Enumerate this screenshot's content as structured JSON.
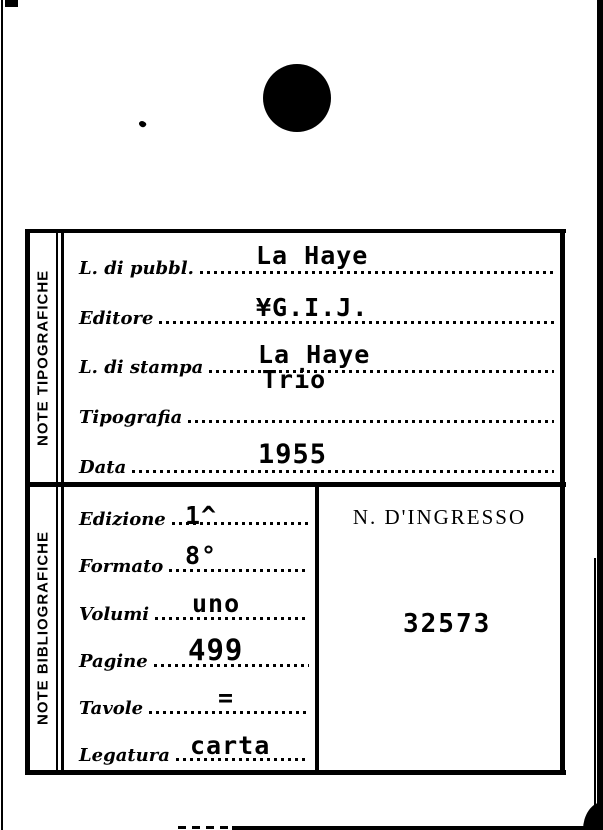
{
  "colors": {
    "ink": "#000000",
    "paper": "#ffffff"
  },
  "card": {
    "hole_punch_icon": "filled-circle",
    "typographic": {
      "side_label": "NOTE TIPOGRAFICHE",
      "fields": [
        {
          "label": "L. di pubbl.",
          "value": "La Haye"
        },
        {
          "label": "Editore",
          "value": "¥G.I.J."
        },
        {
          "label": "L. di stampa",
          "value": "La Haye"
        },
        {
          "label": "Tipografia",
          "value": "Trio"
        },
        {
          "label": "Data",
          "value": "1955"
        }
      ]
    },
    "bibliographic": {
      "side_label": "NOTE BIBLIOGRAFICHE",
      "fields": [
        {
          "label": "Edizione",
          "value": "1^"
        },
        {
          "label": "Formato",
          "value": "8°"
        },
        {
          "label": "Volumi",
          "value": "uno"
        },
        {
          "label": "Pagine",
          "value": "499"
        },
        {
          "label": "Tavole",
          "value": "="
        },
        {
          "label": "Legatura",
          "value": "carta"
        }
      ]
    },
    "ingresso": {
      "heading": "N. D'INGRESSO",
      "number": "32573"
    }
  }
}
